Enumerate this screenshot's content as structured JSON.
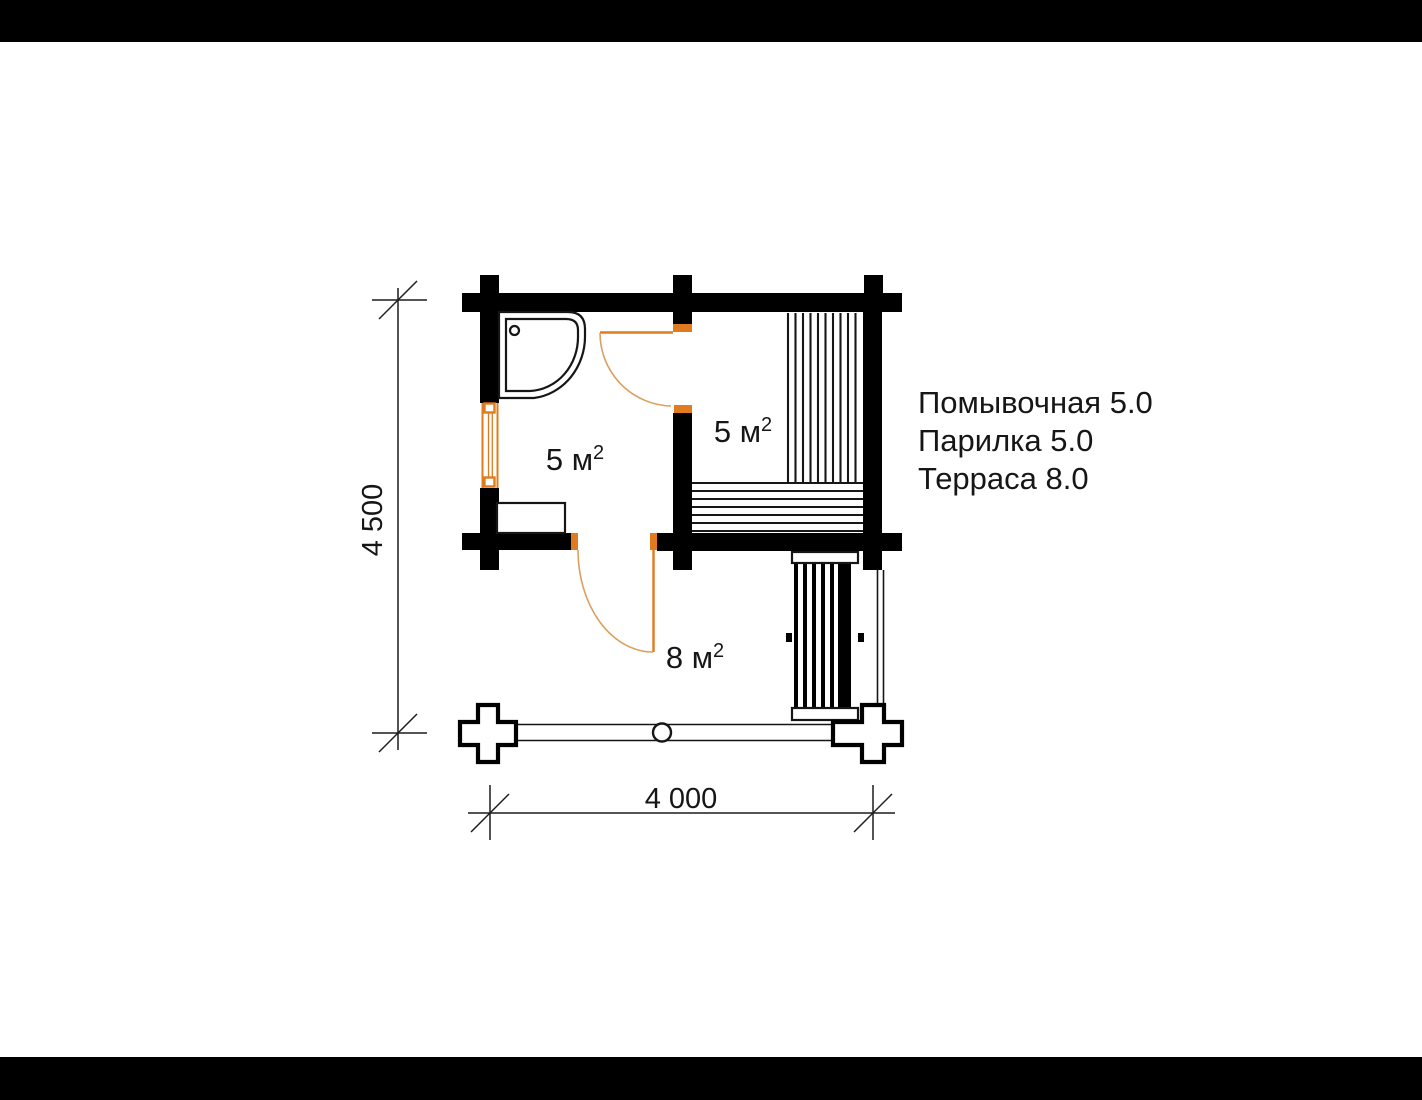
{
  "plan": {
    "type": "sauna-floor-plan",
    "rooms": [
      {
        "name": "Помывочная",
        "label": "5 м",
        "sup": "2"
      },
      {
        "name": "Парилка",
        "label": "5 м",
        "sup": "2"
      },
      {
        "name": "Терраса",
        "label": "8 м",
        "sup": "2"
      }
    ],
    "legend": [
      {
        "text": "Помывочная 5.0"
      },
      {
        "text": "Парилка 5.0"
      },
      {
        "text": "Терраса 8.0"
      }
    ],
    "dimensions": {
      "width": "4 000",
      "height": "4 500"
    },
    "colors": {
      "wall": "#000000",
      "joinery_orange": "#e07b1f",
      "door_arc": "#d9a05f",
      "line": "#161616",
      "background": "#ffffff",
      "letterbox": "#000000"
    }
  }
}
